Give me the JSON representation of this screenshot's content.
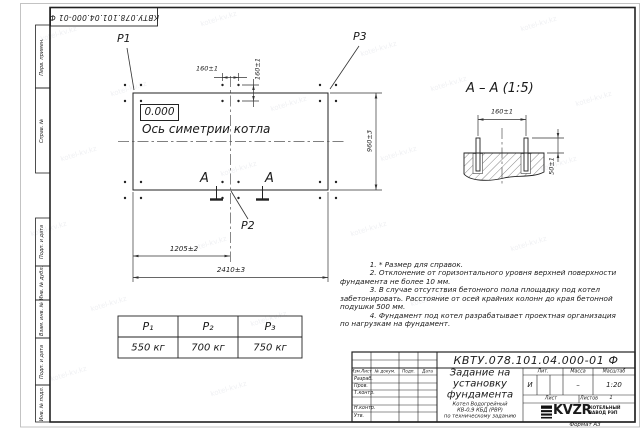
{
  "doc": {
    "number": "КВТУ.078.101.04.000-01 Ф",
    "format_label": "Формат А3"
  },
  "margin_labels": [
    "Перв. примен.",
    "Справ. №",
    "Подп. и дата",
    "Инв. № дубл.",
    "Взам. инв. №",
    "Подп. и дата",
    "Инв. № подл."
  ],
  "plan": {
    "point_labels": [
      "P1",
      "P2",
      "P3"
    ],
    "level_mark": "0.000",
    "axis_label": "Ось симетрии котла",
    "section_letter": "А",
    "dim_bolt_spacing_x": "160±1",
    "dim_bolt_spacing_y": "160±1",
    "dim_half_width": "1205±2",
    "dim_width": "2410±3",
    "dim_height": "960±3"
  },
  "section_view": {
    "title": "А – А (1:5)",
    "dim_bolt_spacing": "160±1",
    "dim_bolt_height": "50±1"
  },
  "notes": "             1. * Размер для справок.\n             2. Отклонение от горизонтального уровня верхней поверхности\nфундамента не более 10 мм.\n             3. В случае отсутствия бетонного пола площадку под котел\nзабетонировать. Расстояние от осей крайних колонн до края бетонной\nподушки 500 мм.\n             4. Фундамент под котел разрабатывает проектная организация\nпо нагрузкам на фундамент.",
  "load_table": {
    "headers": [
      "P₁",
      "P₂",
      "P₃"
    ],
    "values": [
      "550 кг",
      "700 кг",
      "750 кг"
    ]
  },
  "title_block": {
    "doc_title": "Задание на\nустановку\nфундамента",
    "doc_subtitle": "Котел Водогрейный\nКВ-0,9 КБД (РВР)\nпо техническому заданию",
    "rev_headers": [
      "Изм.Лист",
      "№ докум.",
      "Подп.",
      "Дата"
    ],
    "roles": [
      "Разраб.",
      "Пров.",
      "Т.контр.",
      "Н.контр.",
      "Утв."
    ],
    "lit_label": "Лит.",
    "mass_label": "Масса",
    "scale_label": "Масштаб",
    "lit_value": "И",
    "mass_value": "–",
    "scale_value": "1:20",
    "sheet_label": "Лист",
    "sheets_label": "Листов",
    "sheets_value": "1",
    "logo_text": "KVZR",
    "logo_caption": "КОТЕЛЬНЫЙ\nЗАВОД РЭП"
  },
  "watermark": "kotel-kv.kz"
}
